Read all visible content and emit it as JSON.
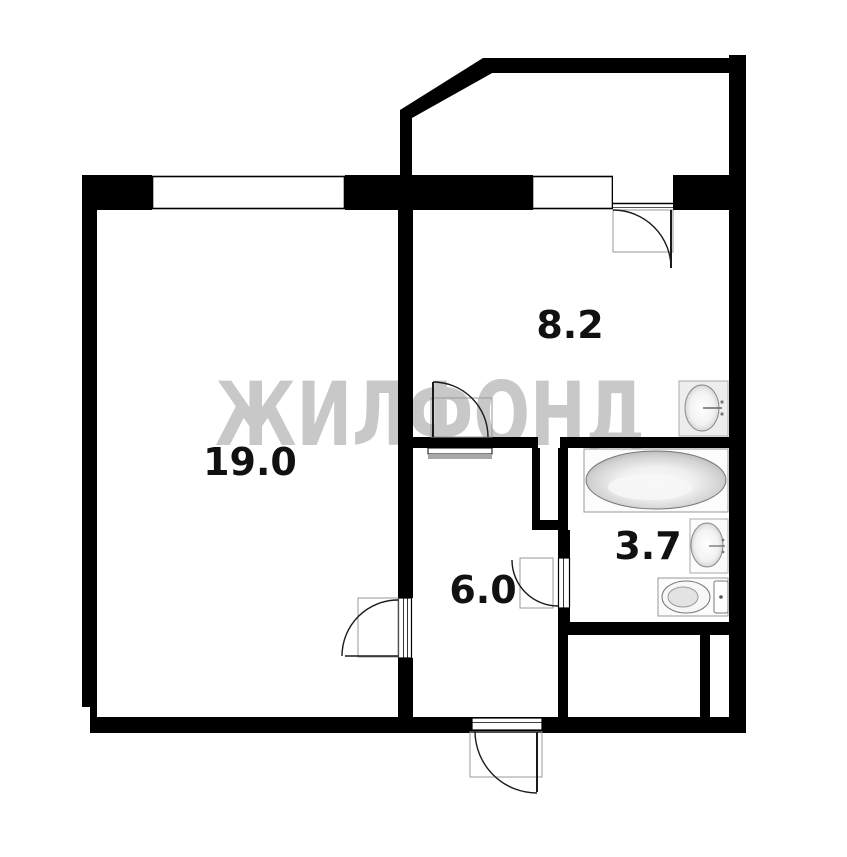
{
  "watermark": {
    "text": "ЖИЛФОНД",
    "color": "#c8c8c8"
  },
  "colors": {
    "wall": "#000000",
    "background": "#ffffff",
    "label": "#111111",
    "door_swing_box": "#9a9a9a"
  },
  "rooms": [
    {
      "id": "living-room",
      "area_label": "19.0"
    },
    {
      "id": "kitchen",
      "area_label": "8.2"
    },
    {
      "id": "hallway",
      "area_label": "6.0"
    },
    {
      "id": "bathroom",
      "area_label": "3.7"
    }
  ],
  "fixtures": [
    {
      "icon": "bathtub-icon"
    },
    {
      "icon": "washbasin-icon"
    },
    {
      "icon": "kitchen-sink-icon"
    },
    {
      "icon": "toilet-icon"
    }
  ],
  "doors": [
    {
      "id": "balcony-door"
    },
    {
      "id": "kitchen-hall-door"
    },
    {
      "id": "living-room-door"
    },
    {
      "id": "bathroom-door"
    },
    {
      "id": "entrance-door"
    }
  ],
  "windows": [
    {
      "id": "living-room-window"
    },
    {
      "id": "kitchen-window"
    }
  ]
}
